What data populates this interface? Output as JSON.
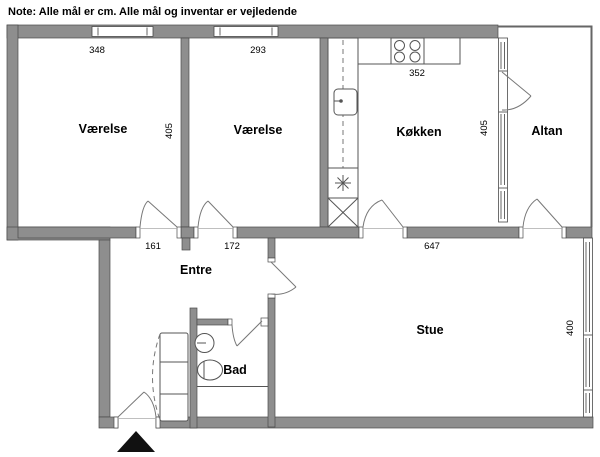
{
  "note": "Note: Alle mål er cm. Alle mål og inventar er vejledende",
  "rooms": {
    "vaerelse1": "Værelse",
    "vaerelse2": "Værelse",
    "koekken": "Køkken",
    "altan": "Altan",
    "entre": "Entre",
    "bad": "Bad",
    "stue": "Stue"
  },
  "dims": {
    "vaerelse1_width": "348",
    "vaerelse2_width": "293",
    "koekken_width": "352",
    "vaerelse_depth": "405",
    "koekken_depth": "405",
    "entre_opening1": "161",
    "entre_opening2": "172",
    "stue_width": "647",
    "stue_depth": "400"
  },
  "colors": {
    "wall": "#8e8e8e",
    "wall-outline": "#4a4a4a",
    "line": "#555555",
    "bg": "#ffffff",
    "text": "#000000"
  }
}
